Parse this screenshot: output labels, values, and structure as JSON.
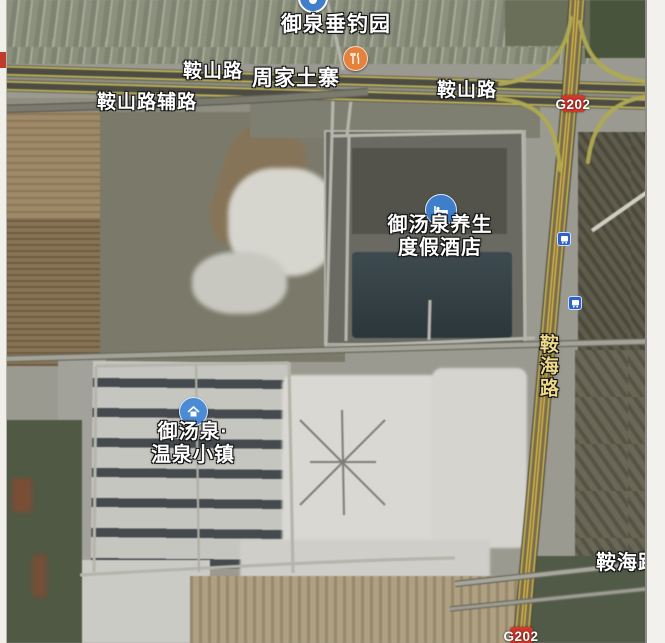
{
  "map": {
    "pois": {
      "fishing_park": {
        "label": "御泉垂钓园",
        "icon": "attraction"
      },
      "restaurant": {
        "label": "周家土寨",
        "icon": "fork-knife"
      },
      "hotel": {
        "label_line1": "御汤泉养生",
        "label_line2": "度假酒店",
        "icon": "hotel-bed"
      },
      "town": {
        "label_line1": "御汤泉·",
        "label_line2": "温泉小镇",
        "icon": "house"
      }
    },
    "roads": {
      "anshan_left": "鞍山路",
      "anshan_service": "鞍山路辅路",
      "anshan_right": "鞍山路",
      "anhai_vertical": "鞍海路",
      "anhai_bottom": "鞍海路"
    },
    "badges": {
      "g202_top": "G202",
      "g202_bottom": "G202"
    },
    "icons": [
      "bus-stop-icon",
      "bus-stop-icon",
      "hotel-bed-icon",
      "house-icon",
      "fork-knife-icon",
      "attraction-icon"
    ],
    "colors": {
      "badge_red": "#d2382c",
      "poi_blue": "#3f7ecb",
      "restaurant_orange": "#e6813c",
      "bus_blue": "#2f62c9",
      "vertical_road_label": "#ecd98a",
      "highway_yellow_line": "#c2b352"
    }
  }
}
